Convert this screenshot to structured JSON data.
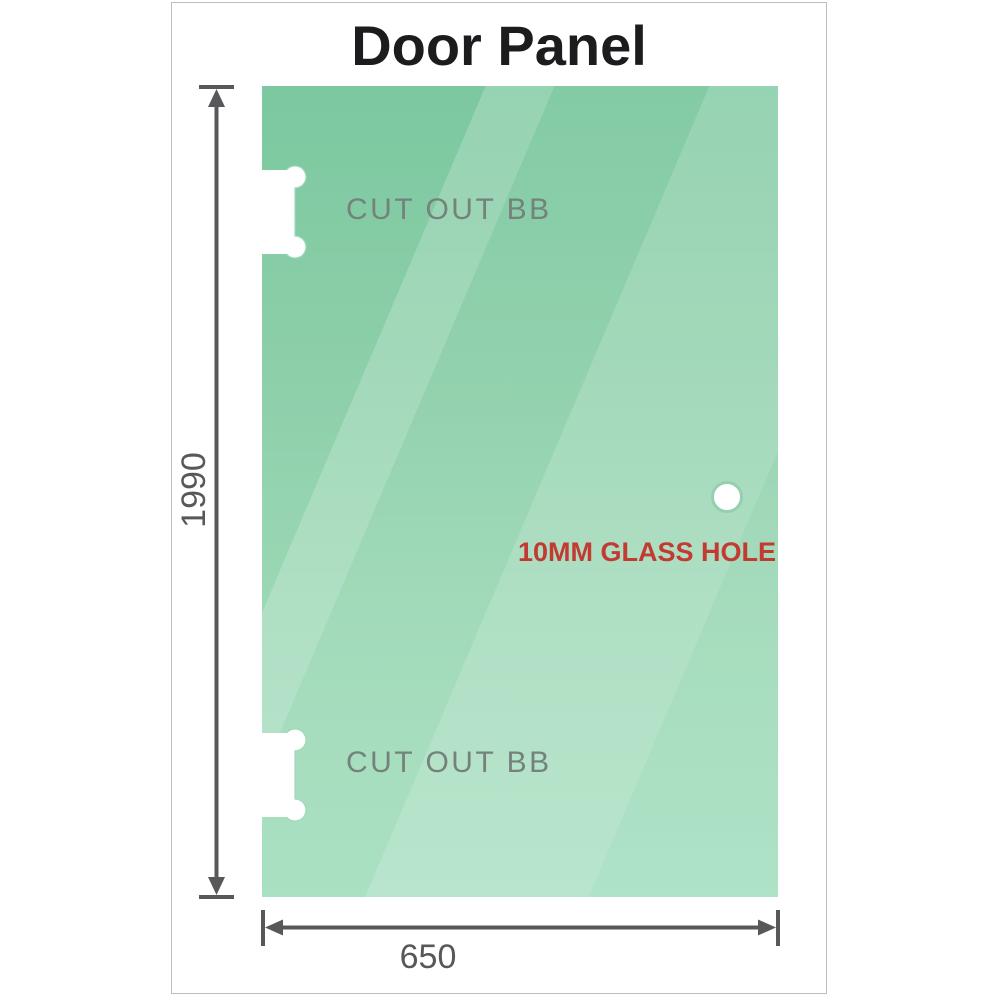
{
  "title": "Door Panel",
  "panel": {
    "cutouts": [
      {
        "label": "CUT OUT BB"
      },
      {
        "label": "CUT OUT BB"
      }
    ],
    "hole": {
      "label": "10MM GLASS HOLE",
      "diameter_mm": "10MM"
    }
  },
  "dimensions": {
    "height": "1990",
    "width": "650"
  },
  "colors": {
    "glass_top": "#7cc8a0",
    "glass_bottom": "#a6dfc0",
    "hole_ring": "#94cfb0",
    "hole_text": "#c23a31",
    "cutout_text": "#75827c",
    "dimension": "#58585a",
    "frame_border": "#bdbdbd",
    "title_text": "#1c1c1e"
  }
}
